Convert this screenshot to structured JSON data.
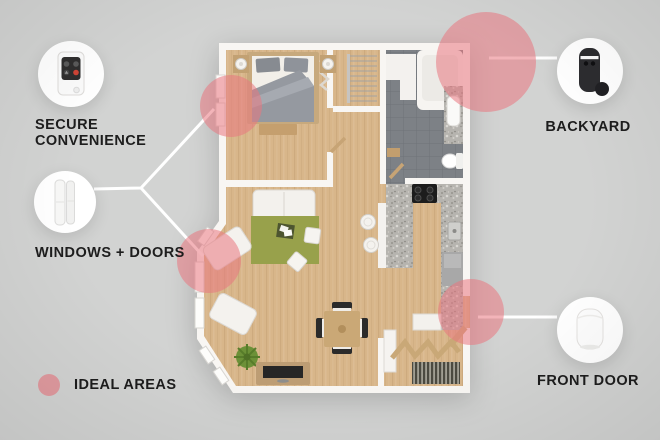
{
  "colors": {
    "background": "#d2d3d2",
    "ideal_area": "#e9777f",
    "connector": "#ffffff",
    "label_text": "#1d1d1d"
  },
  "callouts": {
    "secure_convenience": {
      "line1": "SECURE",
      "line2": "CONVENIENCE",
      "icon": "keyfob-remote-icon"
    },
    "windows_doors": {
      "label": "WINDOWS + DOORS",
      "icon": "entry-sensor-icon"
    },
    "backyard": {
      "label": "BACKYARD",
      "icon": "outdoor-camera-icon"
    },
    "front_door": {
      "label": "FRONT DOOR",
      "icon": "indoor-camera-icon"
    }
  },
  "legend": {
    "label": "IDEAL AREAS",
    "marker": "ideal-area-dot"
  },
  "ideal_areas": [
    {
      "name": "bedroom-window"
    },
    {
      "name": "backyard-bathroom-corner"
    },
    {
      "name": "living-room-window"
    },
    {
      "name": "front-door"
    }
  ]
}
